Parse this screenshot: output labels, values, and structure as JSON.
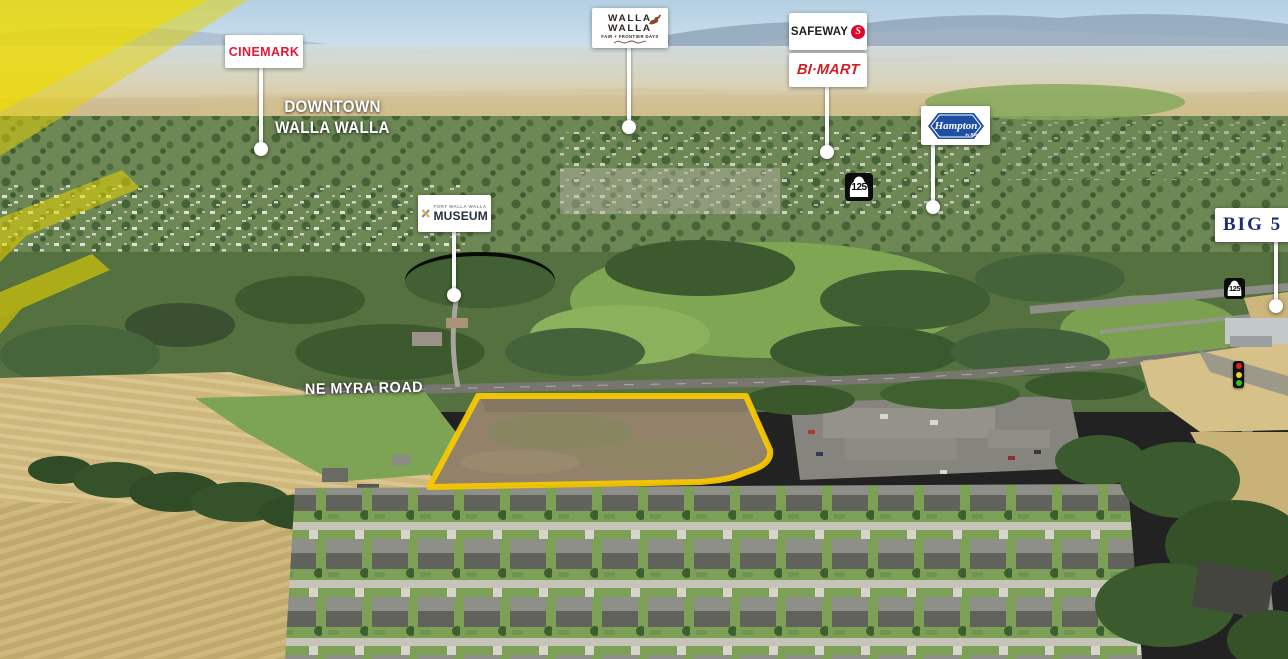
{
  "markers": {
    "cinemark": {
      "label": "CINEMARK"
    },
    "fair": {
      "line1": "WALLA",
      "line2": "WALLA",
      "line3": "FAIR + FRONTIER DAYS"
    },
    "safeway": {
      "label": "SAFEWAY",
      "logo_letter": "S"
    },
    "bimart": {
      "label": "BI·MART"
    },
    "hampton": {
      "label": "Hampton",
      "sub": "by Hilton"
    },
    "big5": {
      "label": "BIG 5"
    },
    "museum": {
      "top": "FORT WALLA WALLA",
      "label": "MUSEUM"
    }
  },
  "area_labels": {
    "downtown_line1": "DOWNTOWN",
    "downtown_line2": "WALLA WALLA",
    "road": "NE MYRA ROAD"
  },
  "route_shields": {
    "primary": "125",
    "secondary": "125"
  },
  "colors": {
    "parcel_outline": "#F6C800",
    "ray_yellow": "#E8D400",
    "cinemark_red": "#E31837",
    "safeway_red": "#E4002B",
    "bimart_red": "#CF2027",
    "hampton_blue": "#1E4FA3",
    "big5_navy": "#1D2D72",
    "museum_navy": "#24313C",
    "museum_orange": "#F0A63C",
    "traffic_red": "#E02020",
    "traffic_yellow": "#E8D51F",
    "traffic_green": "#35C421"
  }
}
